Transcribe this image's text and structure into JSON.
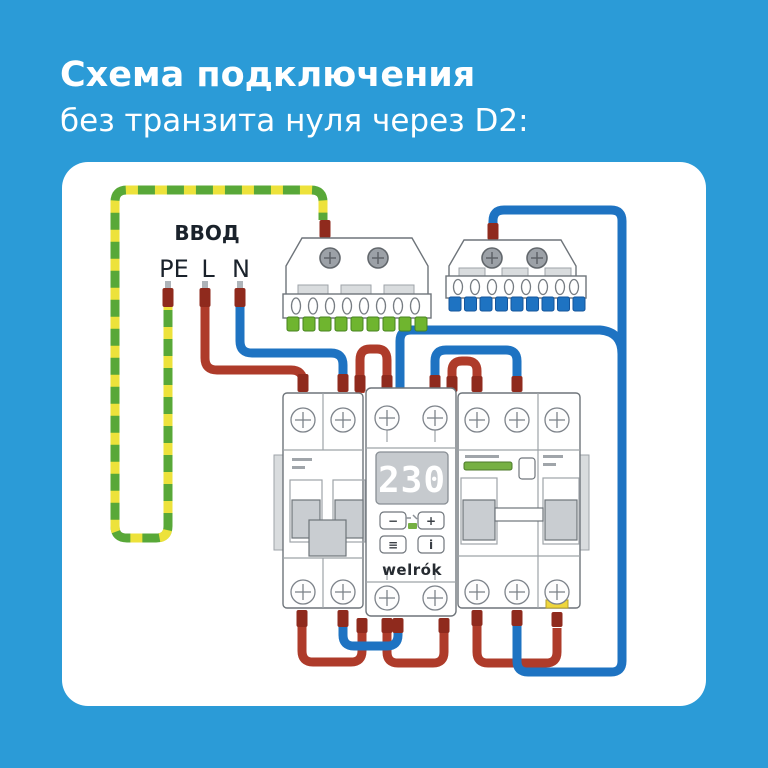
{
  "page": {
    "background": "#2B9BD7",
    "panel": "#FFFFFF"
  },
  "title": {
    "line1": "Схема подключения",
    "line2": "без транзита нуля через D2:"
  },
  "input": {
    "label": "ВВОД",
    "pe": "PE",
    "l": "L",
    "n": "N"
  },
  "relay": {
    "display": "230",
    "brand": "welrók",
    "btn_minus": "−",
    "btn_plus": "+",
    "btn_menu": "≡",
    "btn_info": "i"
  },
  "colors": {
    "phase_wire": "#AE3B2A",
    "neutral_wire": "#1E73C2",
    "pe_green": "#58A838",
    "pe_yellow": "#EDE23B",
    "ferrule": "#8F2A1D",
    "pe_bus_teeth": "#6FB52F",
    "n_bus_teeth": "#1E73C2",
    "led_green": "#76B043",
    "indicator_green": "#76B043",
    "label_yellow": "#EFD63C"
  }
}
